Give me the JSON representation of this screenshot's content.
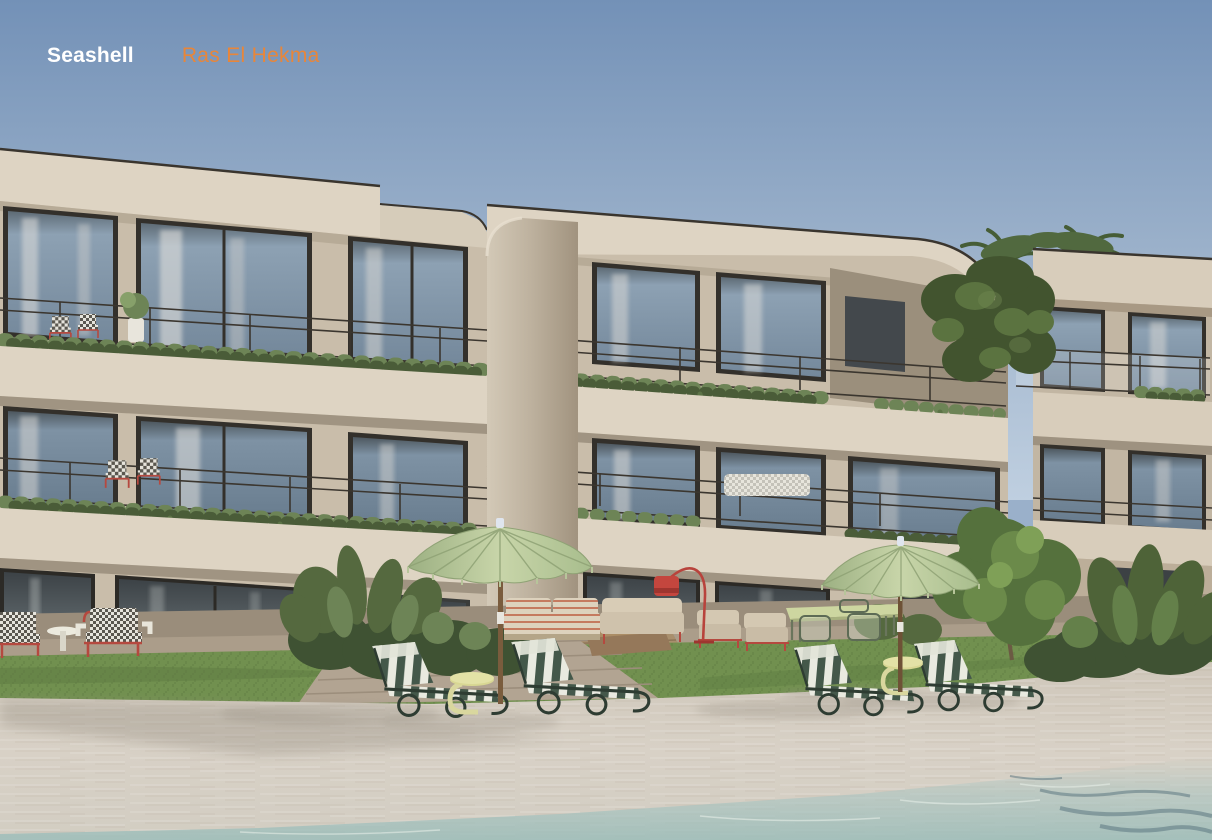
{
  "brand": {
    "name": "Seashell",
    "location": "Ras El Hekma",
    "name_color": "#FFFFFF",
    "location_color": "#E8863A"
  },
  "scene": {
    "alt": "Render of a modern three-storey beachfront apartment building with planted balconies, a lawn, two sage-green parasols, four green-striped sun loungers on sand beside a shallow turquoise pool",
    "umbrella_count": 2,
    "sun_lounger_count": 4,
    "building_floors": 3
  },
  "palette": {
    "accent_orange": "#E8863A",
    "brand_white": "#FFFFFF",
    "sky_top": "#7391B7",
    "sky_horizon": "#BFCFE0",
    "facade_light": "#DED4C3",
    "facade_mid": "#C9BDAA",
    "facade_shadow": "#A39682",
    "glass_blue": "#8FA3B6",
    "glass_dark": "#565E63",
    "frame_dark": "#33302B",
    "foliage_dark": "#4A5C38",
    "foliage_mid": "#6D8456",
    "foliage_light": "#87A06A",
    "lawn_green": "#71904F",
    "sand": "#D3CCC0",
    "water_turquoise": "#A7C4C1",
    "umbrella_sage": "#BFCDA4",
    "lounger_green": "#44584A",
    "furniture_red": "#B5493F",
    "wood": "#8A6844"
  }
}
